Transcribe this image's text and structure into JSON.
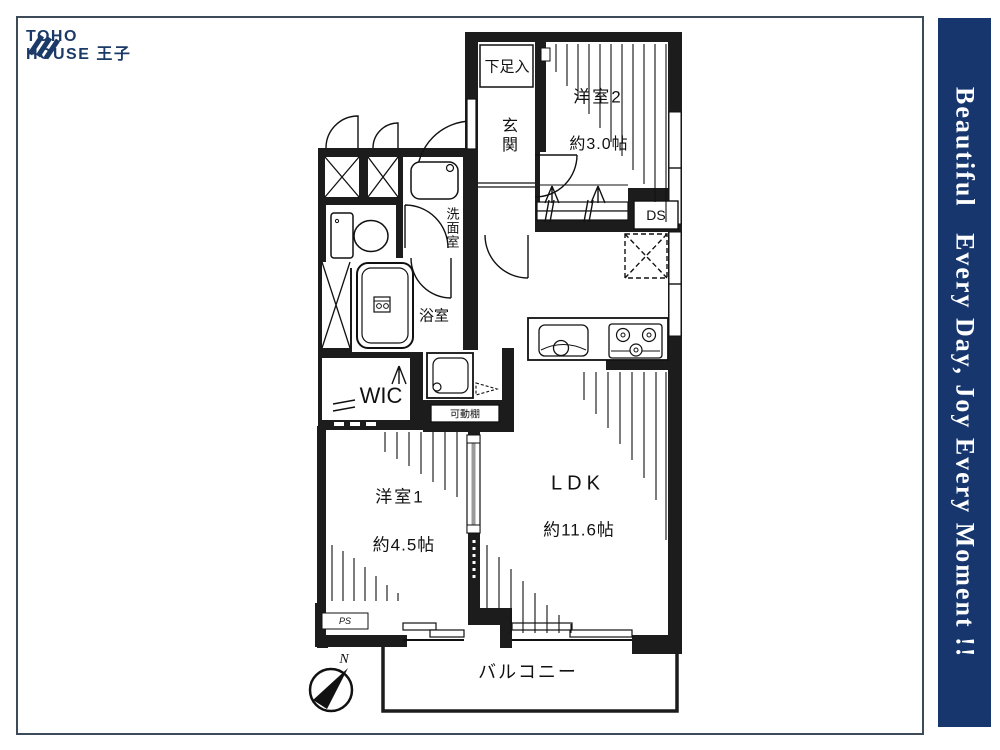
{
  "logo": {
    "line1": "TOHO",
    "line2": "HOUSE 王子",
    "color": "#1b3a68"
  },
  "banner": {
    "text": "Beautiful   Every Day, Joy Every Moment !!",
    "bg": "#16366d",
    "fg": "#ffffff"
  },
  "floorplan": {
    "rooms": {
      "shoe_cabinet": "下足入",
      "entrance": "玄関",
      "bedroom2": "洋室2",
      "bedroom2_size": "約3.0帖",
      "duct_space": "DS",
      "washroom": "洗面室",
      "bathroom": "浴室",
      "wic": "WIC",
      "movable_shelf": "可動棚",
      "bedroom1": "洋室1",
      "bedroom1_size": "約4.5帖",
      "ldk": "LDK",
      "ldk_size": "約11.6帖",
      "pipe_space": "PS",
      "balcony": "バルコニー"
    },
    "compass": {
      "north_label": "N"
    },
    "ink": "#1a1a1a"
  }
}
